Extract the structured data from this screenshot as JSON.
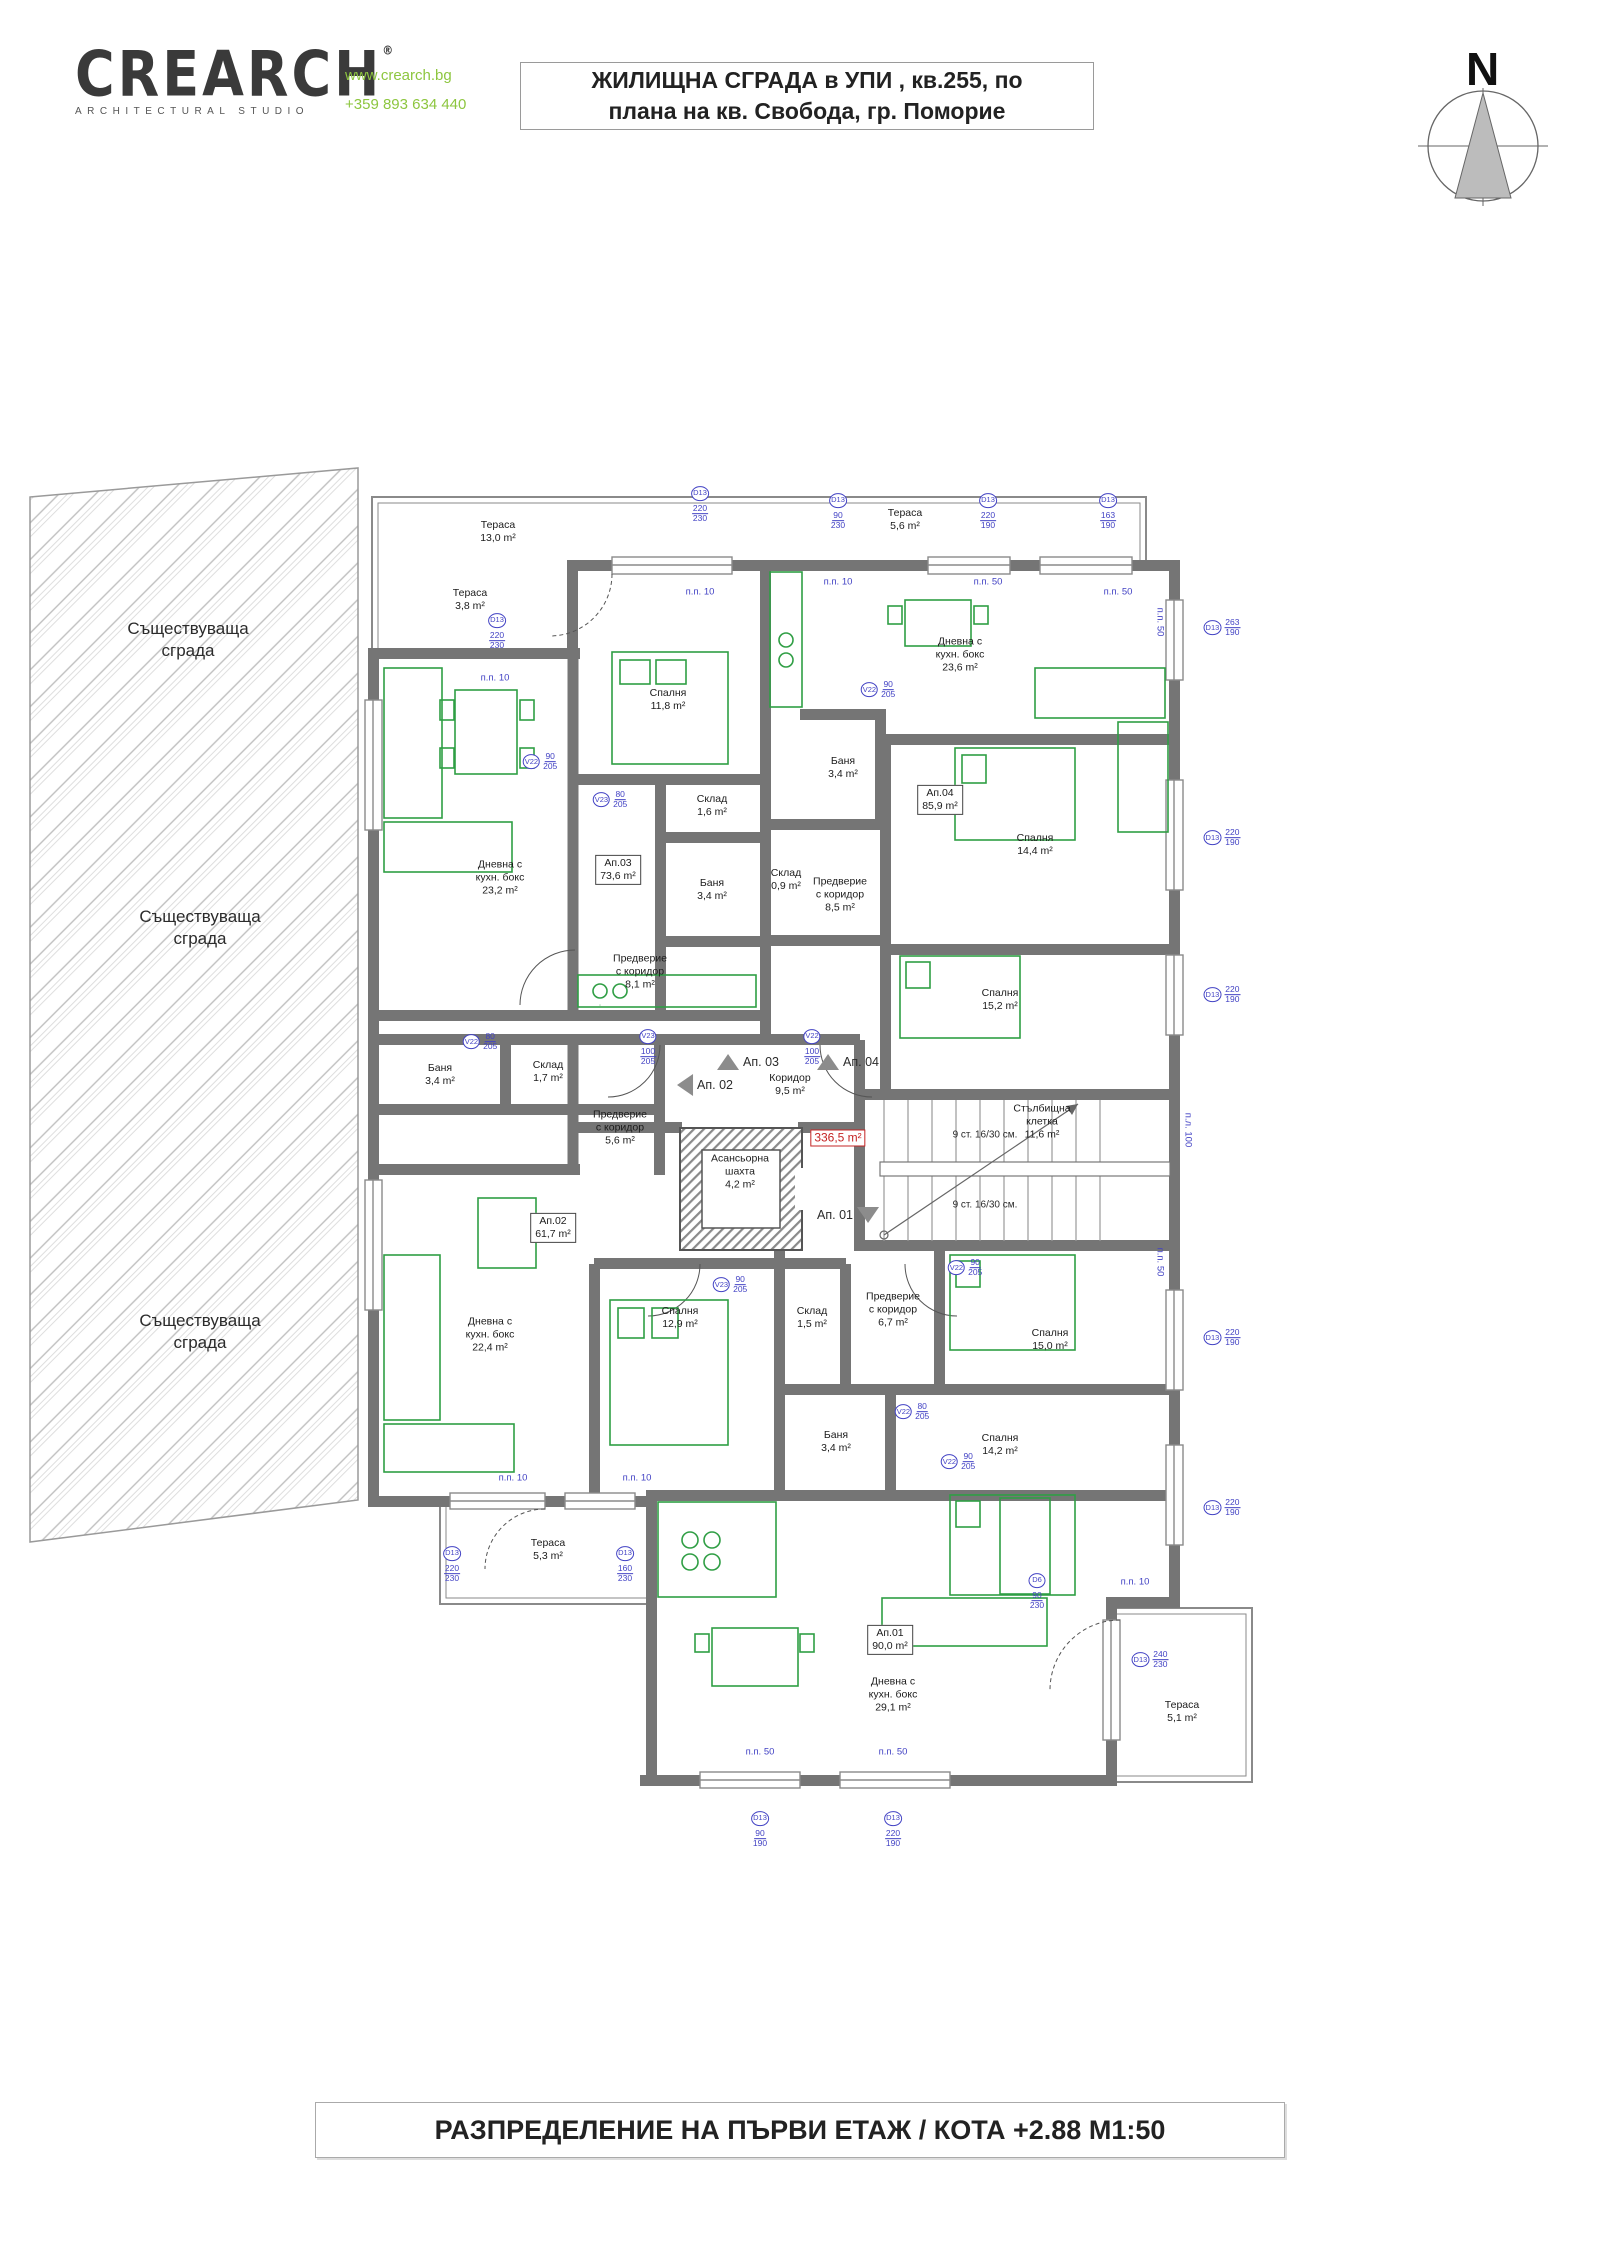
{
  "header": {
    "logo_text": "CREARCH",
    "logo_reg": "®",
    "logo_sub": "ARCHITECTURAL STUDIO",
    "website": "www.crearch.bg",
    "phone": "+359 893 634 440",
    "title_line1": "ЖИЛИЩНА СГРАДА в УПИ , кв.255, по",
    "title_line2": "плана на кв. Свобода, гр. Поморие"
  },
  "north": {
    "label": "N"
  },
  "footer": {
    "title": "РАЗПРЕДЕЛЕНИЕ НА ПЪРВИ ЕТАЖ / КОТА +2.88 М1:50"
  },
  "colors": {
    "furniture": "#2f9e44",
    "dimension": "#4242c4",
    "highlight": "#c42424",
    "wall": "#757575",
    "logo_green": "#8dc63f"
  },
  "plan": {
    "existing_building_labels": [
      {
        "lines": [
          "Съществуваща",
          "сграда"
        ],
        "x": 188,
        "y": 640
      },
      {
        "lines": [
          "Съществуваща",
          "сграда"
        ],
        "x": 200,
        "y": 928
      },
      {
        "lines": [
          "Съществуваща",
          "сграда"
        ],
        "x": 200,
        "y": 1332
      }
    ],
    "rooms": [
      {
        "lines": [
          "Тераса"
        ],
        "area": "13,0 m²",
        "x": 498,
        "y": 532
      },
      {
        "lines": [
          "Тераса"
        ],
        "area": "3,8 m²",
        "x": 470,
        "y": 600
      },
      {
        "lines": [
          "Тераса"
        ],
        "area": "5,6 m²",
        "x": 905,
        "y": 520
      },
      {
        "lines": [
          "Спалня"
        ],
        "area": "11,8 m²",
        "x": 668,
        "y": 700
      },
      {
        "lines": [
          "Склад"
        ],
        "area": "1,6 m²",
        "x": 712,
        "y": 806
      },
      {
        "lines": [
          "Баня"
        ],
        "area": "3,4 m²",
        "x": 712,
        "y": 890
      },
      {
        "lines": [
          "Ап.03"
        ],
        "area": "73,6 m²",
        "x": 618,
        "y": 870,
        "boxed": true
      },
      {
        "lines": [
          "Дневна с",
          "кухн. бокс"
        ],
        "area": "23,2 m²",
        "x": 500,
        "y": 878
      },
      {
        "lines": [
          "Предверие",
          "с коридор"
        ],
        "area": "8,1 m²",
        "x": 640,
        "y": 972
      },
      {
        "lines": [
          "Дневна с",
          "кухн. бокс"
        ],
        "area": "23,6 m²",
        "x": 960,
        "y": 655
      },
      {
        "lines": [
          "Баня"
        ],
        "area": "3,4 m²",
        "x": 843,
        "y": 768
      },
      {
        "lines": [
          "Ап.04"
        ],
        "area": "85,9 m²",
        "x": 940,
        "y": 800,
        "boxed": true
      },
      {
        "lines": [
          "Склад"
        ],
        "area": "0,9 m²",
        "x": 786,
        "y": 880
      },
      {
        "lines": [
          "Предверие",
          "с коридор"
        ],
        "area": "8,5 m²",
        "x": 840,
        "y": 895
      },
      {
        "lines": [
          "Спалня"
        ],
        "area": "14,4 m²",
        "x": 1035,
        "y": 845
      },
      {
        "lines": [
          "Спалня"
        ],
        "area": "15,2 m²",
        "x": 1000,
        "y": 1000
      },
      {
        "lines": [
          "Коридор"
        ],
        "area": "9,5 m²",
        "x": 790,
        "y": 1085
      },
      {
        "lines": [
          "Асансьорна",
          "шахта"
        ],
        "area": "4,2 m²",
        "x": 740,
        "y": 1172
      },
      {
        "lines": [
          "Стълбищна",
          "клетка"
        ],
        "area": "11,6 m²",
        "x": 1042,
        "y": 1122
      },
      {
        "lines": [
          "Баня"
        ],
        "area": "3,4 m²",
        "x": 440,
        "y": 1075
      },
      {
        "lines": [
          "Склад"
        ],
        "area": "1,7 m²",
        "x": 548,
        "y": 1072
      },
      {
        "lines": [
          "Предверие",
          "с коридор"
        ],
        "area": "5,6 m²",
        "x": 620,
        "y": 1128
      },
      {
        "lines": [
          "Ап.02"
        ],
        "area": "61,7 m²",
        "x": 553,
        "y": 1228,
        "boxed": true
      },
      {
        "lines": [
          "Дневна с",
          "кухн. бокс"
        ],
        "area": "22,4 m²",
        "x": 490,
        "y": 1335
      },
      {
        "lines": [
          "Спалня"
        ],
        "area": "12,9 m²",
        "x": 680,
        "y": 1318
      },
      {
        "lines": [
          "Тераса"
        ],
        "area": "5,3 m²",
        "x": 548,
        "y": 1550
      },
      {
        "lines": [
          "Склад"
        ],
        "area": "1,5 m²",
        "x": 812,
        "y": 1318
      },
      {
        "lines": [
          "Предверие",
          "с коридор"
        ],
        "area": "6,7 m²",
        "x": 893,
        "y": 1310
      },
      {
        "lines": [
          "Баня"
        ],
        "area": "3,4 m²",
        "x": 836,
        "y": 1442
      },
      {
        "lines": [
          "Спалня"
        ],
        "area": "15,0 m²",
        "x": 1050,
        "y": 1340
      },
      {
        "lines": [
          "Спалня"
        ],
        "area": "14,2 m²",
        "x": 1000,
        "y": 1445
      },
      {
        "lines": [
          "Ап.01"
        ],
        "area": "90,0 m²",
        "x": 890,
        "y": 1640,
        "boxed": true
      },
      {
        "lines": [
          "Дневна с",
          "кухн. бокс"
        ],
        "area": "29,1 m²",
        "x": 893,
        "y": 1695
      },
      {
        "lines": [
          "Тераса"
        ],
        "area": "5,1 m²",
        "x": 1182,
        "y": 1712
      }
    ],
    "area_total": {
      "text": "336,5 m²",
      "x": 838,
      "y": 1138
    },
    "apartment_markers": [
      {
        "text": "Ап. 03",
        "x": 748,
        "y": 1062,
        "dir": "up"
      },
      {
        "text": "Ап. 04",
        "x": 848,
        "y": 1062,
        "dir": "up"
      },
      {
        "text": "Ап. 02",
        "x": 705,
        "y": 1085,
        "dir": "left"
      },
      {
        "text": "Ап. 01",
        "x": 848,
        "y": 1215,
        "dir": "down"
      }
    ],
    "stair_notes": [
      {
        "text": "9 ст. 16/30 см.",
        "x": 985,
        "y": 1135
      },
      {
        "text": "9 ст. 16/30 см.",
        "x": 985,
        "y": 1205
      }
    ],
    "dim_markers": [
      {
        "tag": "D13",
        "top": "220",
        "bottom": "230",
        "x": 497,
        "y": 632,
        "vert": true
      },
      {
        "tag": "D13",
        "top": "220",
        "bottom": "230",
        "x": 700,
        "y": 505,
        "vert": true
      },
      {
        "tag": "D13",
        "top": "90",
        "bottom": "230",
        "x": 838,
        "y": 512,
        "vert": true
      },
      {
        "tag": "D13",
        "top": "220",
        "bottom": "190",
        "x": 988,
        "y": 512,
        "vert": true
      },
      {
        "tag": "D13",
        "top": "163",
        "bottom": "190",
        "x": 1108,
        "y": 512,
        "vert": true
      },
      {
        "tag": "D13",
        "top": "263",
        "bottom": "190",
        "x": 1222,
        "y": 628
      },
      {
        "tag": "D13",
        "top": "220",
        "bottom": "190",
        "x": 1222,
        "y": 838
      },
      {
        "tag": "D13",
        "top": "220",
        "bottom": "190",
        "x": 1222,
        "y": 995
      },
      {
        "tag": "D13",
        "top": "220",
        "bottom": "190",
        "x": 1222,
        "y": 1338
      },
      {
        "tag": "D13",
        "top": "220",
        "bottom": "190",
        "x": 1222,
        "y": 1508
      },
      {
        "tag": "D13",
        "top": "220",
        "bottom": "230",
        "x": 452,
        "y": 1565,
        "vert": true
      },
      {
        "tag": "D13",
        "top": "160",
        "bottom": "230",
        "x": 625,
        "y": 1565,
        "vert": true
      },
      {
        "tag": "D13",
        "top": "90",
        "bottom": "190",
        "x": 760,
        "y": 1830,
        "vert": true
      },
      {
        "tag": "D13",
        "top": "220",
        "bottom": "190",
        "x": 893,
        "y": 1830,
        "vert": true
      },
      {
        "tag": "D13",
        "top": "240",
        "bottom": "230",
        "x": 1150,
        "y": 1660
      },
      {
        "tag": "D6",
        "top": "90",
        "bottom": "230",
        "x": 1037,
        "y": 1592,
        "vert": true
      },
      {
        "tag": "V22",
        "top": "90",
        "bottom": "205",
        "x": 540,
        "y": 762
      },
      {
        "tag": "V23",
        "top": "80",
        "bottom": "205",
        "x": 610,
        "y": 800
      },
      {
        "tag": "V22",
        "top": "90",
        "bottom": "205",
        "x": 878,
        "y": 690
      },
      {
        "tag": "V23",
        "top": "100",
        "bottom": "205",
        "x": 648,
        "y": 1048,
        "vert": true
      },
      {
        "tag": "V22",
        "top": "100",
        "bottom": "205",
        "x": 812,
        "y": 1048,
        "vert": true
      },
      {
        "tag": "V23",
        "top": "90",
        "bottom": "205",
        "x": 730,
        "y": 1285
      },
      {
        "tag": "V22",
        "top": "80",
        "bottom": "205",
        "x": 912,
        "y": 1412
      },
      {
        "tag": "V22",
        "top": "90",
        "bottom": "205",
        "x": 965,
        "y": 1268
      },
      {
        "tag": "V22",
        "top": "90",
        "bottom": "205",
        "x": 958,
        "y": 1462
      },
      {
        "tag": "V22",
        "top": "80",
        "bottom": "205",
        "x": 480,
        "y": 1042
      }
    ],
    "opening_labels": [
      {
        "text": "п.п. 10",
        "x": 495,
        "y": 678
      },
      {
        "text": "п.п. 10",
        "x": 700,
        "y": 592
      },
      {
        "text": "п.п. 10",
        "x": 838,
        "y": 582
      },
      {
        "text": "п.п. 50",
        "x": 988,
        "y": 582
      },
      {
        "text": "п.п. 50",
        "x": 1118,
        "y": 592
      },
      {
        "text": "п.п. 50",
        "x": 1160,
        "y": 622,
        "vert": true
      },
      {
        "text": "п.п. 10",
        "x": 513,
        "y": 1478
      },
      {
        "text": "п.п. 10",
        "x": 637,
        "y": 1478
      },
      {
        "text": "п.п. 50",
        "x": 760,
        "y": 1752
      },
      {
        "text": "п.п. 50",
        "x": 893,
        "y": 1752
      },
      {
        "text": "п.п. 10",
        "x": 1135,
        "y": 1582
      },
      {
        "text": "п.п. 50",
        "x": 1160,
        "y": 1262,
        "vert": true
      },
      {
        "text": "п.л. 100",
        "x": 1188,
        "y": 1130,
        "vert": true
      }
    ]
  }
}
